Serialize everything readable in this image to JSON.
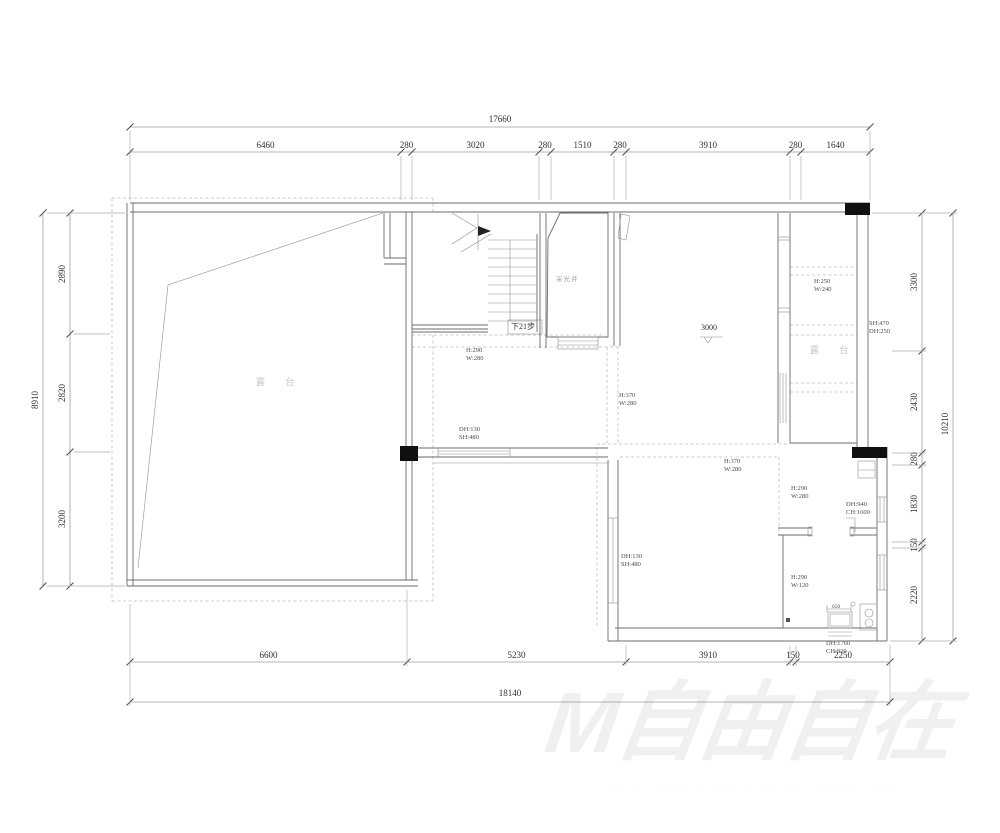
{
  "dimensions": {
    "top": {
      "total": "17660",
      "segments": [
        "6460",
        "280",
        "3020",
        "280",
        "1510",
        "280",
        "3910",
        "280",
        "1640"
      ]
    },
    "bottom": {
      "total": "18140",
      "segments": [
        "6600",
        "5230",
        "3910",
        "150",
        "2250"
      ]
    },
    "left": {
      "total": "8910",
      "segments": [
        "2890",
        "2820",
        "3200"
      ]
    },
    "right": {
      "total": "10210",
      "segments": [
        "3300",
        "2430",
        "280",
        "1830",
        "150",
        "2220"
      ]
    }
  },
  "annotations": [
    {
      "text": "H:290\nW:280",
      "x": 466,
      "y": 347,
      "cls": "ann"
    },
    {
      "text": "下21步",
      "x": 511,
      "y": 321,
      "cls": "dark"
    },
    {
      "text": "采光井",
      "x": 556,
      "y": 273,
      "cls": "room-sm"
    },
    {
      "text": "露 台",
      "x": 256,
      "y": 375,
      "cls": "room"
    },
    {
      "text": "3000",
      "x": 701,
      "y": 323,
      "cls": "dark"
    },
    {
      "text": "H:250\nW:240",
      "x": 814,
      "y": 278,
      "cls": "ann"
    },
    {
      "text": "SH:470\nDH:250",
      "x": 869,
      "y": 320,
      "cls": "ann"
    },
    {
      "text": "露 台",
      "x": 810,
      "y": 343,
      "cls": "room"
    },
    {
      "text": "H:370\nW:280",
      "x": 619,
      "y": 392,
      "cls": "ann"
    },
    {
      "text": "H:370\nW:280",
      "x": 724,
      "y": 458,
      "cls": "ann"
    },
    {
      "text": "H:290\nW:280",
      "x": 791,
      "y": 485,
      "cls": "ann"
    },
    {
      "text": "DH:940\nCH:1600",
      "x": 846,
      "y": 501,
      "cls": "ann"
    },
    {
      "text": "DH:130\nSH:480",
      "x": 459,
      "y": 426,
      "cls": "ann"
    },
    {
      "text": "DH:130\nSH:480",
      "x": 621,
      "y": 553,
      "cls": "ann"
    },
    {
      "text": "H:290\nW:120",
      "x": 791,
      "y": 574,
      "cls": "ann"
    },
    {
      "text": "DH:1760\nCH:820",
      "x": 826,
      "y": 640,
      "cls": "ann"
    },
    {
      "text": "650",
      "x": 832,
      "y": 604,
      "cls": "ann-xs"
    }
  ],
  "watermark": {
    "main": "M自由自在",
    "sub": "·· · ···· ···· ··· ·· ····· ···"
  },
  "colors": {
    "wall": "#6b6b6b",
    "dashed": "#bdbdbd",
    "column": "#101010",
    "dimension_text": "#2e2e2e"
  }
}
